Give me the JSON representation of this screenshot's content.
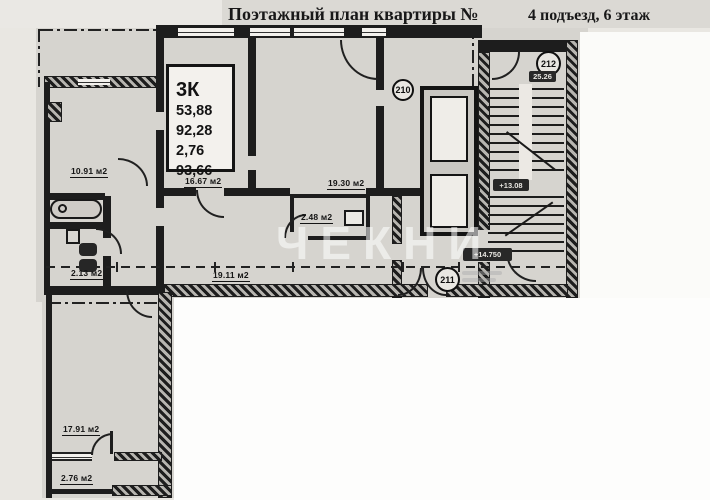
{
  "header": {
    "title": "Поэтажный план квартиры №",
    "subtitle": "4 подъезд, 6 этаж"
  },
  "apartment_info": {
    "type": "3К",
    "lines": [
      "53,88",
      "92,28",
      "2,76",
      "93,66"
    ]
  },
  "room_labels": {
    "hall_top": "10.91 м2",
    "room_center": "16.67 м2",
    "room_right": "19.30 м2",
    "bathroom_small": "2.48 м2",
    "living_bottom": "19.11 м2",
    "wc_left": "2.13 м2",
    "wing_room": "17.91 м2",
    "wing_loggia": "2.76 м2"
  },
  "unit_numbers": {
    "lobby": "210",
    "corridor": "211",
    "stair_top": "212"
  },
  "elevation_marks": {
    "stairs": "+13.08",
    "landing": "+14.750",
    "note": "25.26"
  },
  "watermark": {
    "text": "ЧЕКНИ"
  },
  "colors": {
    "paper": "#d6d4cf",
    "wall": "#1d1d1d",
    "cover": "#fdfdfc",
    "ink": "#181818"
  }
}
